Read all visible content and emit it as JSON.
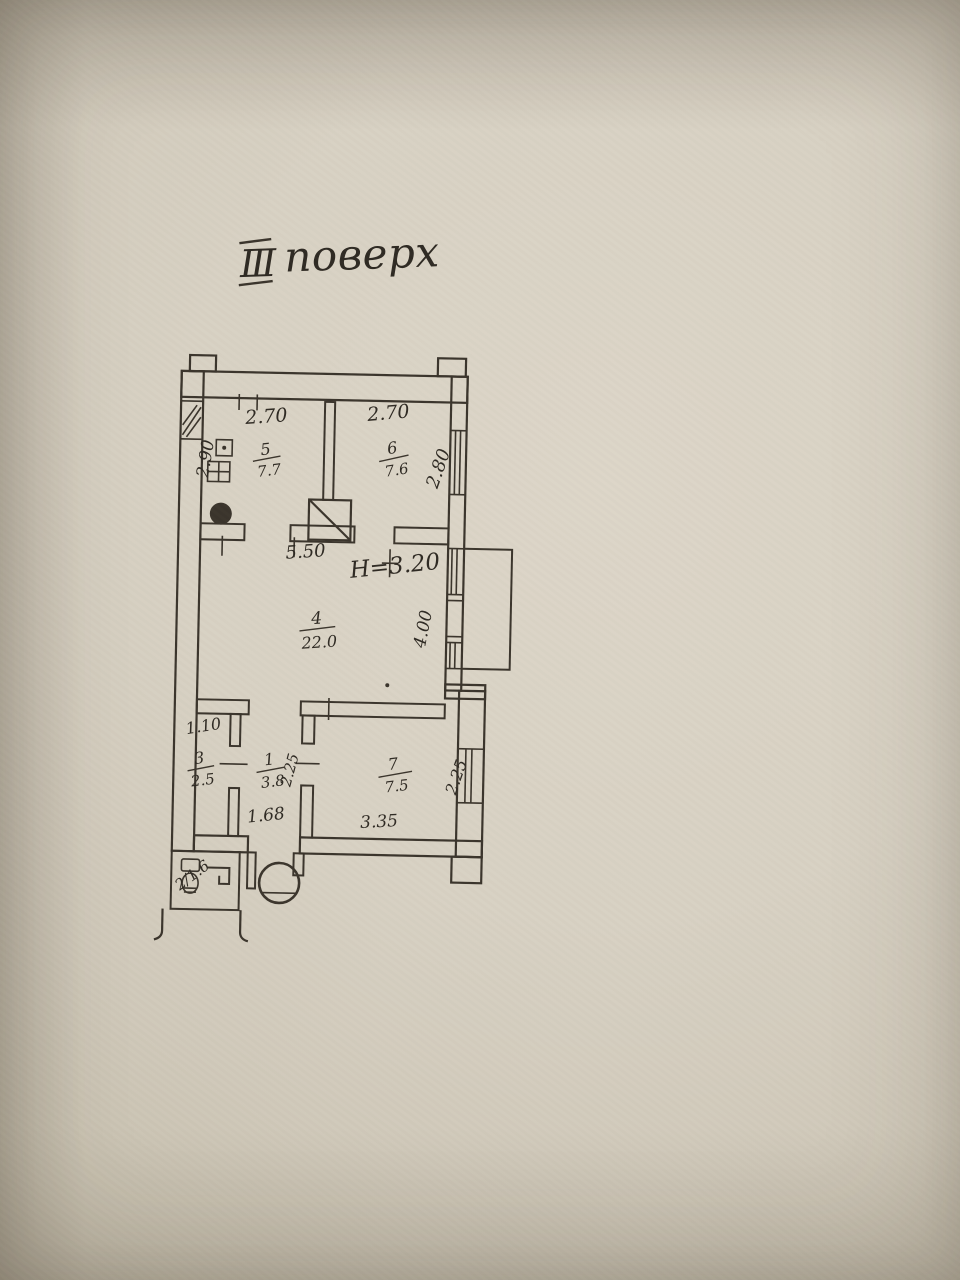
{
  "photo": {
    "title_numeral": "Ⅲ",
    "title_word": "поверх"
  },
  "plan": {
    "height_note": "H=3.20",
    "rooms": {
      "r5": {
        "num": "5",
        "area": "7.7"
      },
      "r6": {
        "num": "6",
        "area": "7.6"
      },
      "r4": {
        "num": "4",
        "area": "22.0"
      },
      "r3": {
        "num": "3",
        "area": "2.5"
      },
      "r1": {
        "num": "1",
        "area": "3.8"
      },
      "r7": {
        "num": "7",
        "area": "7.5"
      },
      "r2": {
        "label": "2/1.6"
      }
    },
    "dimensions": {
      "room5_width": "2.70",
      "room6_width": "2.70",
      "room5_depth": "2.90",
      "room6_depth": "2.80",
      "room4_width": "5.50",
      "room4_depth": "4.00",
      "room3_width": "1.10",
      "room1_width": "1.68",
      "room1_depth": "2.25",
      "room7_width": "3.35",
      "room7_depth": "2.25"
    }
  }
}
